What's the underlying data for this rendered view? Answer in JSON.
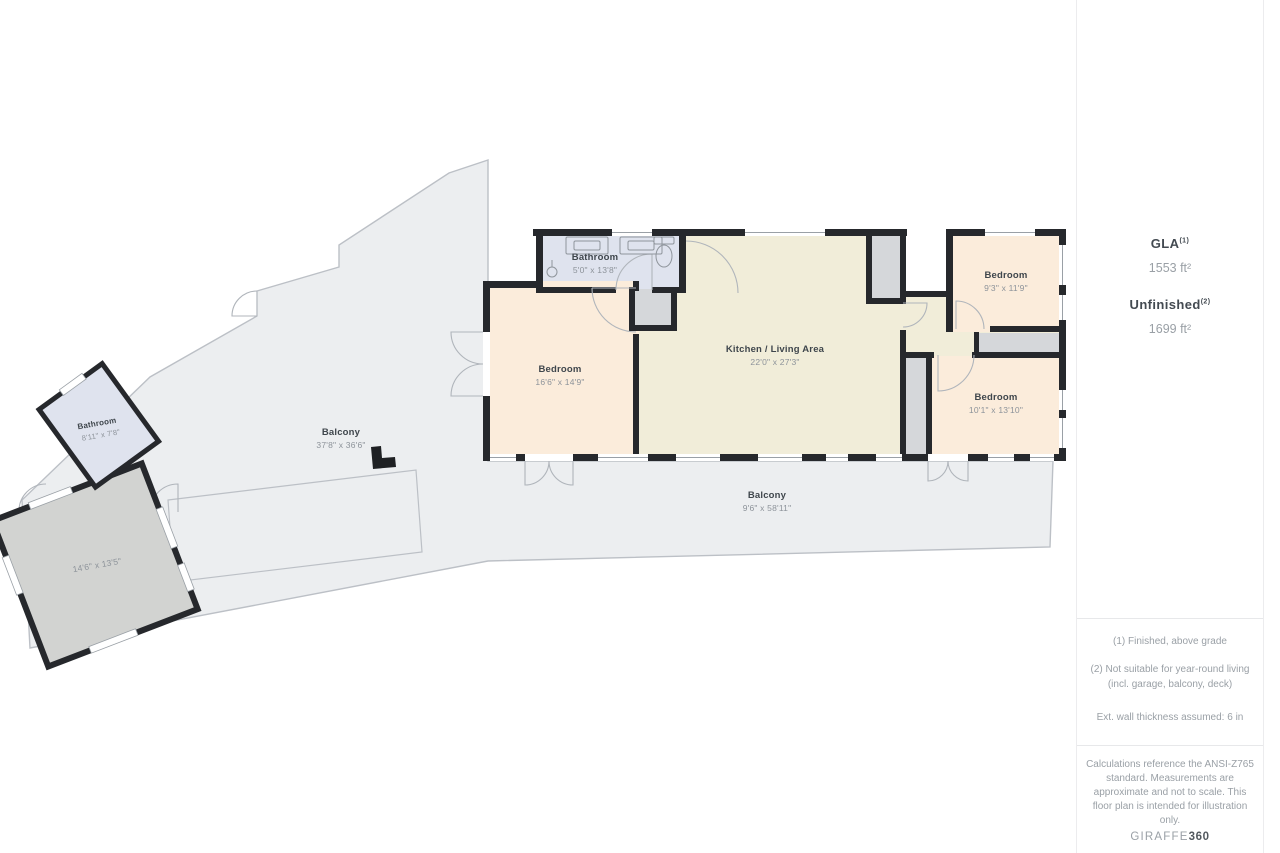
{
  "plan": {
    "rooms": {
      "bathroom_main": {
        "name": "Bathroom",
        "dims": "5'0\" x 13'8\""
      },
      "bedroom_left": {
        "name": "Bedroom",
        "dims": "16'6\" x 14'9\""
      },
      "kitchen_living": {
        "name": "Kitchen / Living Area",
        "dims": "22'0\" x 27'3\""
      },
      "bedroom_top_right": {
        "name": "Bedroom",
        "dims": "9'3\" x 11'9\""
      },
      "bedroom_bottom_right": {
        "name": "Bedroom",
        "dims": "10'1\" x 13'10\""
      },
      "bathroom_small": {
        "name": "Bathroom",
        "dims": "8'11\" x 7'8\""
      },
      "balcony_left": {
        "name": "Balcony",
        "dims": "37'8\" x 36'6\""
      },
      "balcony_bottom": {
        "name": "Balcony",
        "dims": "9'6\" x 58'11\""
      },
      "garage": {
        "dims": "14'6\" x 13'5\""
      }
    },
    "colors": {
      "walls": "#26282c",
      "bedroom_fill": "#fbecdb",
      "kitchen_fill": "#f1edd9",
      "bathroom_fill": "#dfe3ee",
      "closet_fill": "#d5d7da",
      "outdoor_fill": "#eceef0",
      "garage_fill": "#d2d3d1"
    }
  },
  "sidebar": {
    "gla_label": "GLA",
    "gla_sup": "(1)",
    "gla_value": "1553 ft²",
    "unfinished_label": "Unfinished",
    "unfinished_sup": "(2)",
    "unfinished_value": "1699 ft²",
    "footnotes": [
      "(1) Finished, above grade",
      "(2) Not suitable for year-round living (incl. garage, balcony, deck)",
      "Ext. wall thickness assumed: 6 in"
    ],
    "disclaimer": "Calculations reference the ANSI-Z765 standard. Measurements are approximate and not to scale. This floor plan is intended for illustration only.",
    "logo_left": "GIRAFFE",
    "logo_right": "360"
  }
}
